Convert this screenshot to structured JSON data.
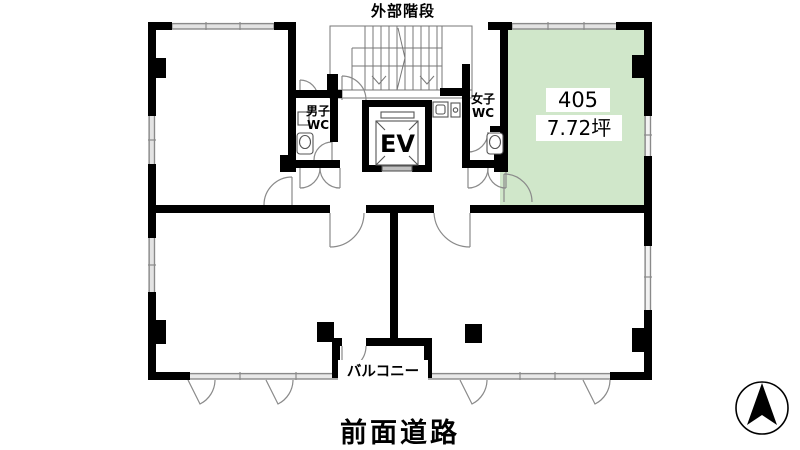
{
  "plan": {
    "stair_label": "外部階段",
    "room405_number": "405",
    "room405_area": "7.72坪",
    "mens_wc_line1": "男子",
    "mens_wc_line2": "WC",
    "womens_wc_line1": "女子",
    "womens_wc_line2": "WC",
    "elevator_label": "EV",
    "balcony_label": "バルコニー",
    "road_label": "前面道路"
  },
  "colors": {
    "highlight_room_fill": "#d0e7ca",
    "wall": "#000000",
    "thin_line": "#8a8a8a"
  }
}
